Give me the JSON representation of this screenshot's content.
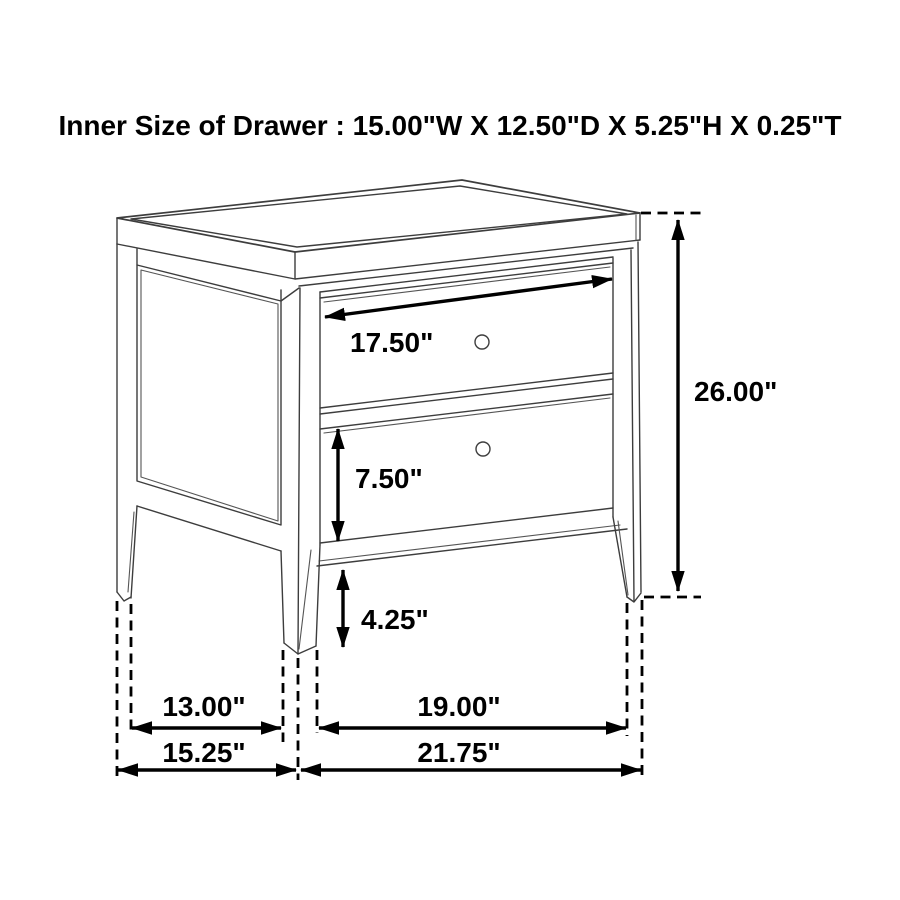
{
  "title": "Inner Size of Drawer : 15.00\"W X 12.50\"D X 5.25\"H X 0.25\"T",
  "diagram": {
    "type": "furniture-dimension-line-drawing",
    "subject": "two-drawer nightstand",
    "labels": {
      "drawer_front_width": "17.50\"",
      "overall_height": "26.00\"",
      "drawer_front_height": "7.50\"",
      "leg_clearance_height": "4.25\"",
      "side_leg_span_inner": "13.00\"",
      "front_leg_span_inner": "19.00\"",
      "side_depth_overall": "15.25\"",
      "front_width_overall": "21.75\""
    },
    "colors": {
      "line_art": "#3d3d3d",
      "dimension_ink": "#000000",
      "background": "#ffffff"
    }
  }
}
